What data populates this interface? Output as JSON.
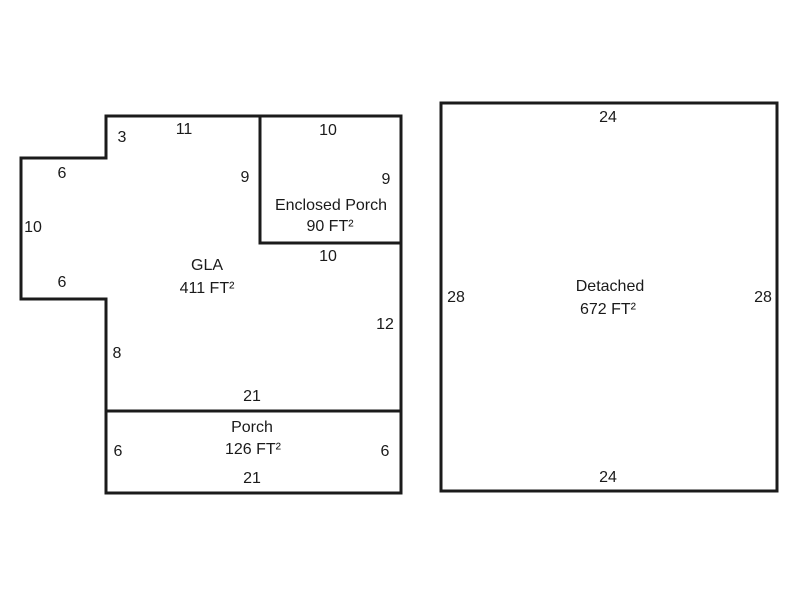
{
  "diagram": {
    "type": "floorplan-sketch",
    "colors": {
      "background": "#ffffff",
      "line": "#1b1b1b",
      "text": "#1a1a1a"
    },
    "main_building": {
      "gla": {
        "name": "GLA",
        "area": "411 FT²"
      },
      "enclosed_porch": {
        "name": "Enclosed Porch",
        "area": "90 FT²"
      },
      "porch": {
        "name": "Porch",
        "area": "126 FT²"
      },
      "dims": {
        "top_step": "3",
        "top": "11",
        "notch_top": "6",
        "notch_left": "10",
        "notch_bottom": "6",
        "ep_left_inner": "9",
        "ep_right": "9",
        "ep_top": "10",
        "ep_bottom": "10",
        "right": "12",
        "left_lower": "8",
        "porch_top": "21",
        "porch_left": "6",
        "porch_right": "6",
        "porch_bottom": "21"
      }
    },
    "detached_building": {
      "name": "Detached",
      "area": "672 FT²",
      "dims": {
        "top": "24",
        "left": "28",
        "right": "28",
        "bottom": "24"
      }
    }
  }
}
